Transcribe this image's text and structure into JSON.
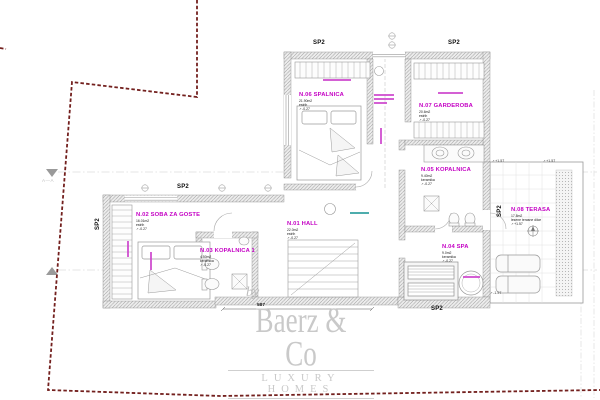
{
  "drawing": {
    "sp2": "SP2",
    "section_marker": "A—A",
    "dimension": "587",
    "rooms": [
      {
        "name": "N.06 SPALNICA",
        "area": "21.90m2",
        "floor": "estrih",
        "level": "-0.27"
      },
      {
        "name": "N.07 GARDEROBA",
        "area": "20.6m2",
        "floor": "estrih",
        "level": "-0.27"
      },
      {
        "name": "N.02 SOBA ZA GOSTE",
        "area": "16.01m2",
        "floor": "estrih",
        "level": "-0.27"
      },
      {
        "name": "N.03 KOPALNICA 1",
        "area": "4.50m2",
        "floor": "keramika",
        "level": "-0.27"
      },
      {
        "name": "N.01 HALL",
        "area": "22.0m2",
        "floor": "estrih",
        "level": "-0.27"
      },
      {
        "name": "N.05 KOPALNICA",
        "area": "9.40m2",
        "floor": "keramika",
        "level": "-0.27"
      },
      {
        "name": "N.04 SPA",
        "area": "9.0m2",
        "floor": "keramika",
        "level": "-0.27"
      },
      {
        "name": "N.08 TERASA",
        "area": "17.8m2",
        "floor": "lesene terasne dilce",
        "level": "+1.57"
      }
    ],
    "level_marks": [
      "+1.57",
      "+1.57",
      "-1.57"
    ],
    "logo": {
      "by": "by",
      "name": "Baerz & Co",
      "tagline": "LUXURY HOMES"
    },
    "colors": {
      "boundary": "#73201e",
      "room_label": "#c400c4",
      "wall_hatch": "#a5a5a5"
    }
  }
}
